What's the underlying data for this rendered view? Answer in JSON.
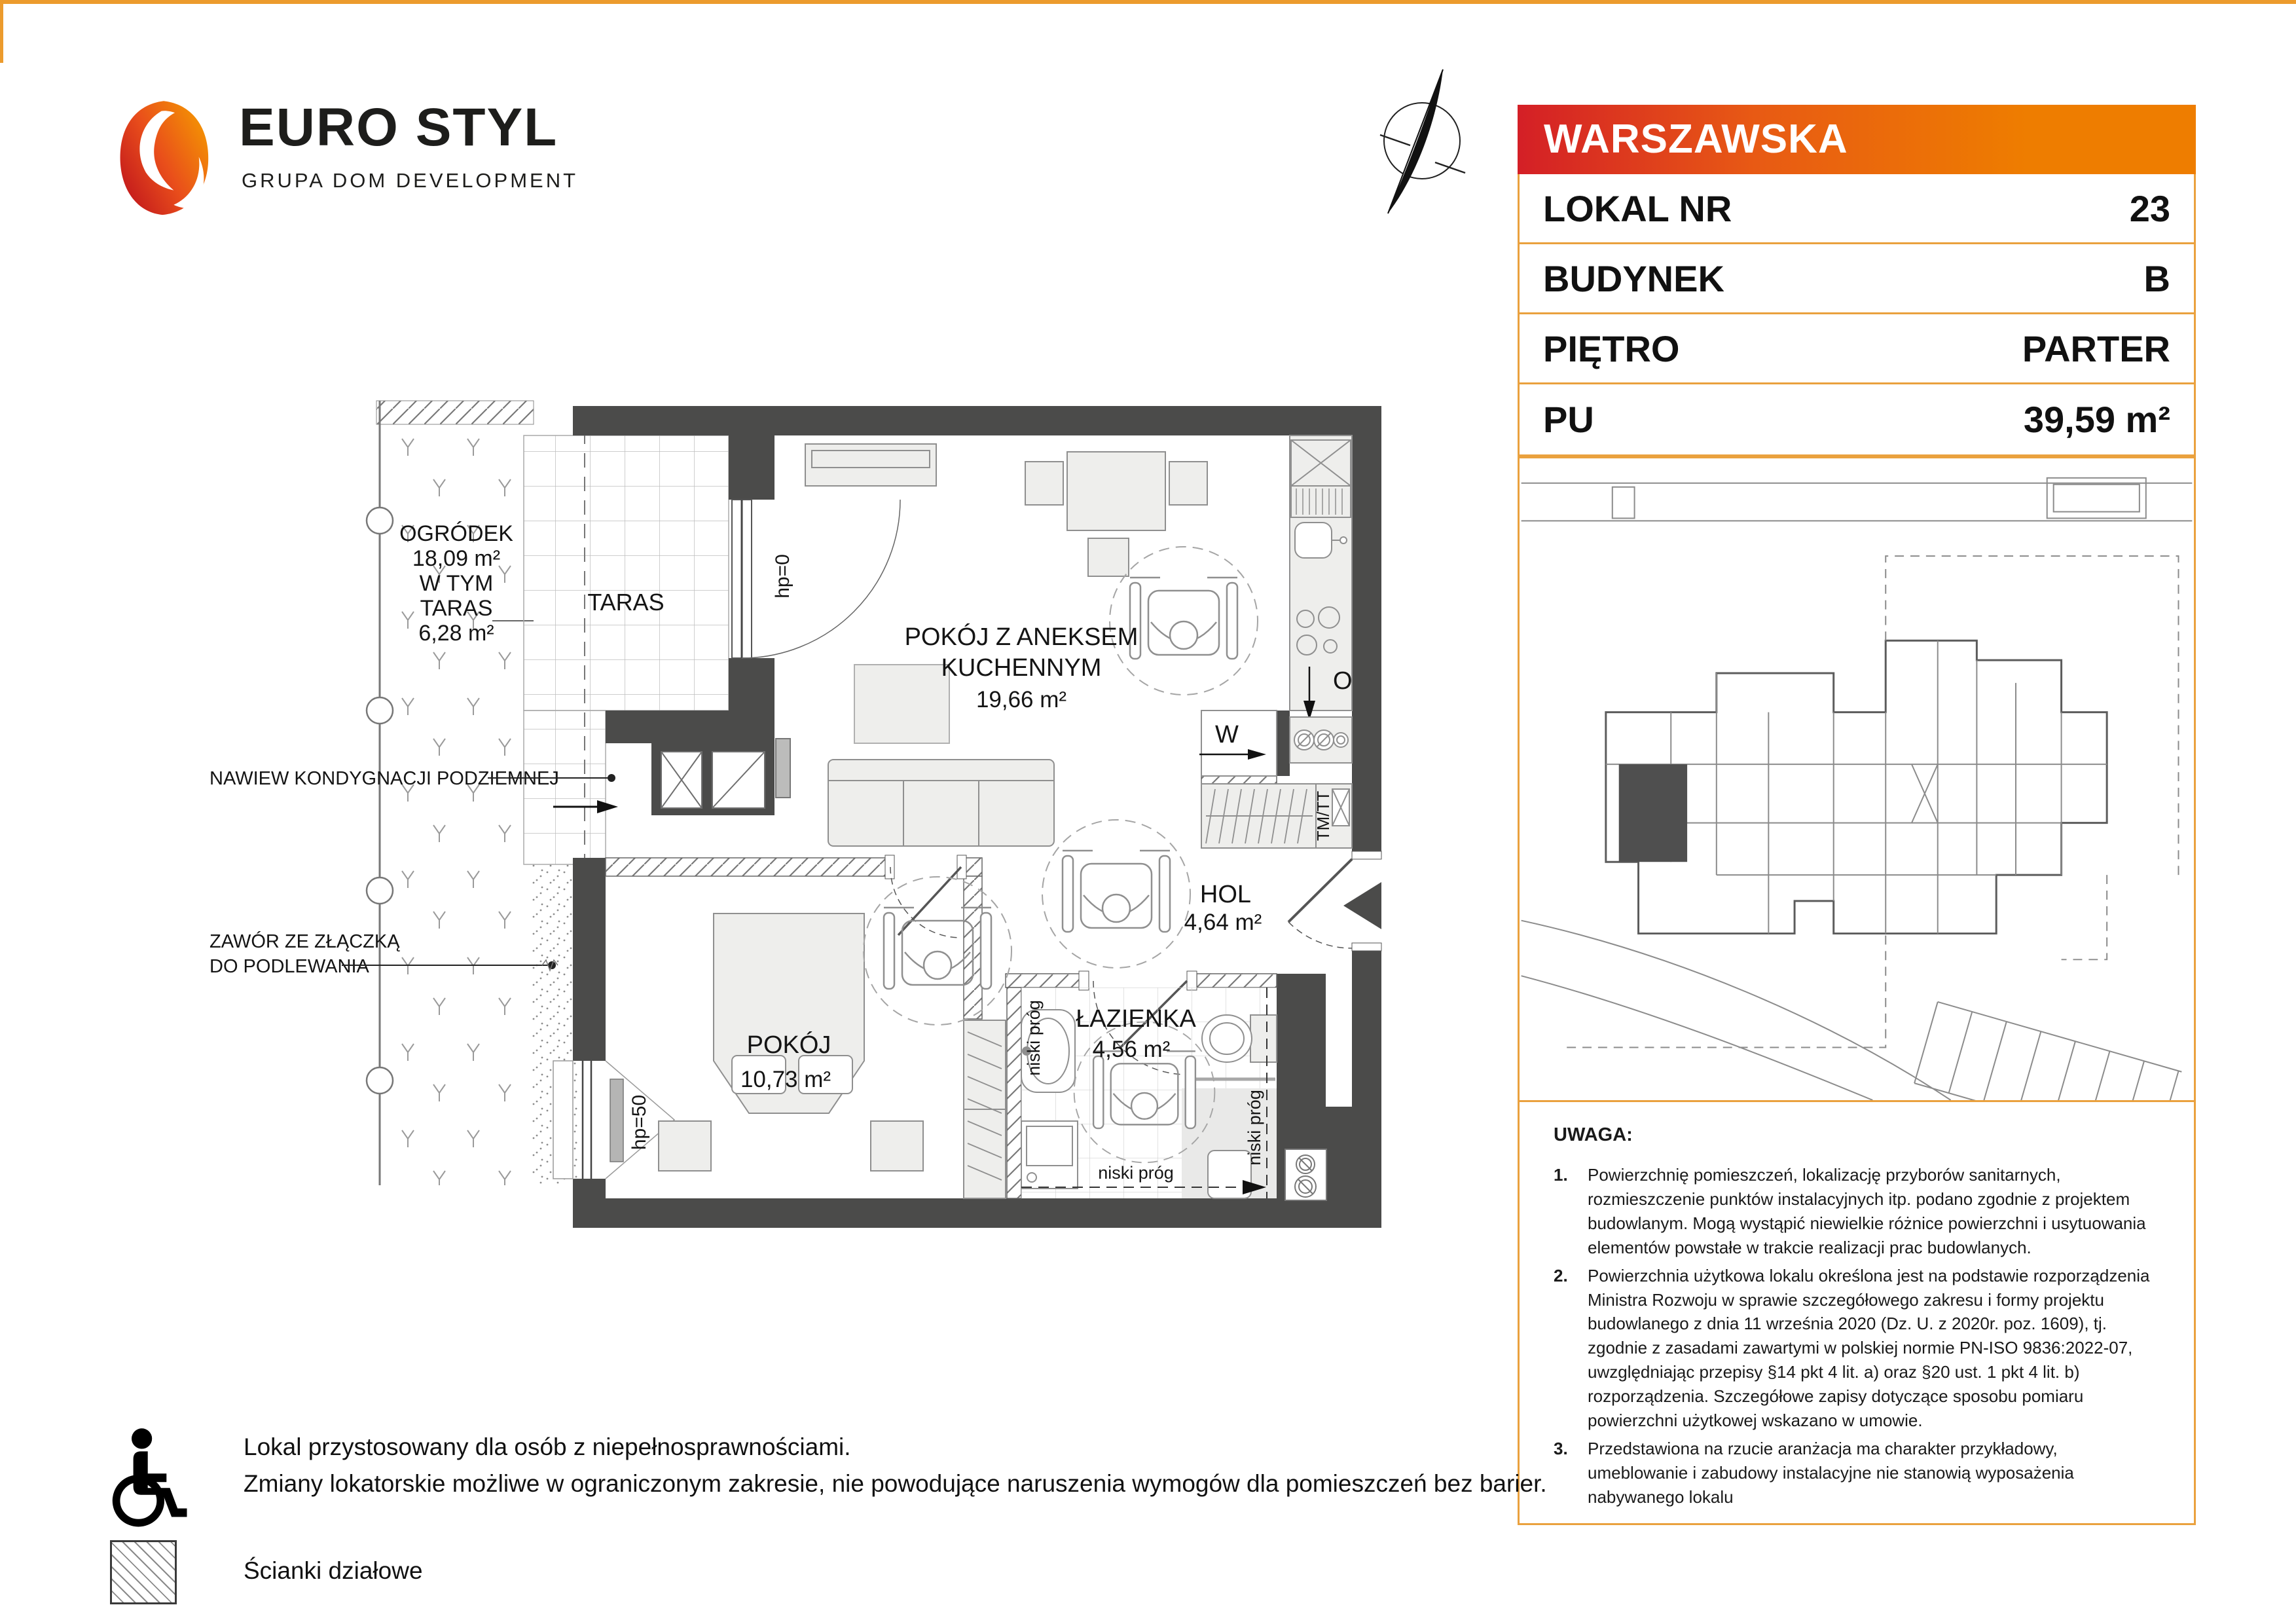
{
  "logo": {
    "brand": "EURO STYL",
    "group": "GRUPA DOM DEVELOPMENT"
  },
  "panel": {
    "estate": "WARSZAWSKA",
    "rows": [
      {
        "label": "LOKAL NR",
        "value": "23"
      },
      {
        "label": "BUDYNEK",
        "value": "B"
      },
      {
        "label": "PIĘTRO",
        "value": "PARTER"
      },
      {
        "label": "PU",
        "value": "39,59 m²"
      }
    ]
  },
  "plan": {
    "living": {
      "name_line1": "POKÓJ Z ANEKSEM",
      "name_line2": "KUCHENNYM",
      "area": "19,66 m²"
    },
    "bedroom": {
      "name": "POKÓJ",
      "area": "10,73 m²"
    },
    "bathroom": {
      "name": "ŁAZIENKA",
      "area": "4,56 m²"
    },
    "hall": {
      "name": "HOL",
      "area": "4,64 m²"
    },
    "terrace_label": "TARAS",
    "garden": {
      "line1": "OGRÓDEK",
      "line2": "18,09 m²",
      "line3": "W TYM",
      "line4": "TARAS",
      "line5": "6,28 m²"
    },
    "annotations": {
      "hp0": "hp=0",
      "hp50": "hp=50",
      "niski_prog": "niski próg",
      "washer": "W",
      "oven": "O",
      "tmtt": "TM/TT",
      "nawiew": "NAWIEW KONDYGNACJI PODZIEMNEJ",
      "zawor_line1": "ZAWÓR ZE ZŁĄCZKĄ",
      "zawor_line2": "DO PODLEWANIA"
    }
  },
  "notes": {
    "title": "UWAGA:",
    "items": [
      {
        "num": "1.",
        "text": "Powierzchnię pomieszczeń, lokalizację przyborów sanitarnych, rozmieszczenie punktów instalacyjnych itp. podano zgodnie z projektem budowlanym. Mogą wystąpić niewielkie różnice powierzchni i usytuowania elementów powstałe w trakcie realizacji prac budowlanych."
      },
      {
        "num": "2.",
        "text": "Powierzchnia użytkowa lokalu określona jest na podstawie rozporządzenia Ministra Rozwoju w sprawie szczegółowego zakresu i formy projektu budowlanego z dnia 11 września 2020 (Dz. U. z 2020r. poz. 1609), tj. zgodnie z zasadami zawartymi w polskiej normie PN-ISO 9836:2022-07, uwzględniając przepisy §14 pkt 4 lit. a) oraz §20 ust. 1 pkt 4 lit. b) rozporządzenia. Szczegółowe zapisy dotyczące sposobu pomiaru powierzchni użytkowej wskazano w umowie."
      },
      {
        "num": "3.",
        "text": "Przedstawiona na rzucie aranżacja ma charakter przykładowy, umeblowanie i zabudowy instalacyjne nie stanowią wyposażenia nabywanego lokalu"
      }
    ]
  },
  "legend": {
    "access_line1": "Lokal przystosowany dla osób z niepełnosprawnościami.",
    "access_line2": "Zmiany lokatorskie możliwe w ograniczonym zakresie, nie powodujące naruszenia wymogów dla pomieszczeń bez barier.",
    "partitions": "Ścianki działowe"
  }
}
